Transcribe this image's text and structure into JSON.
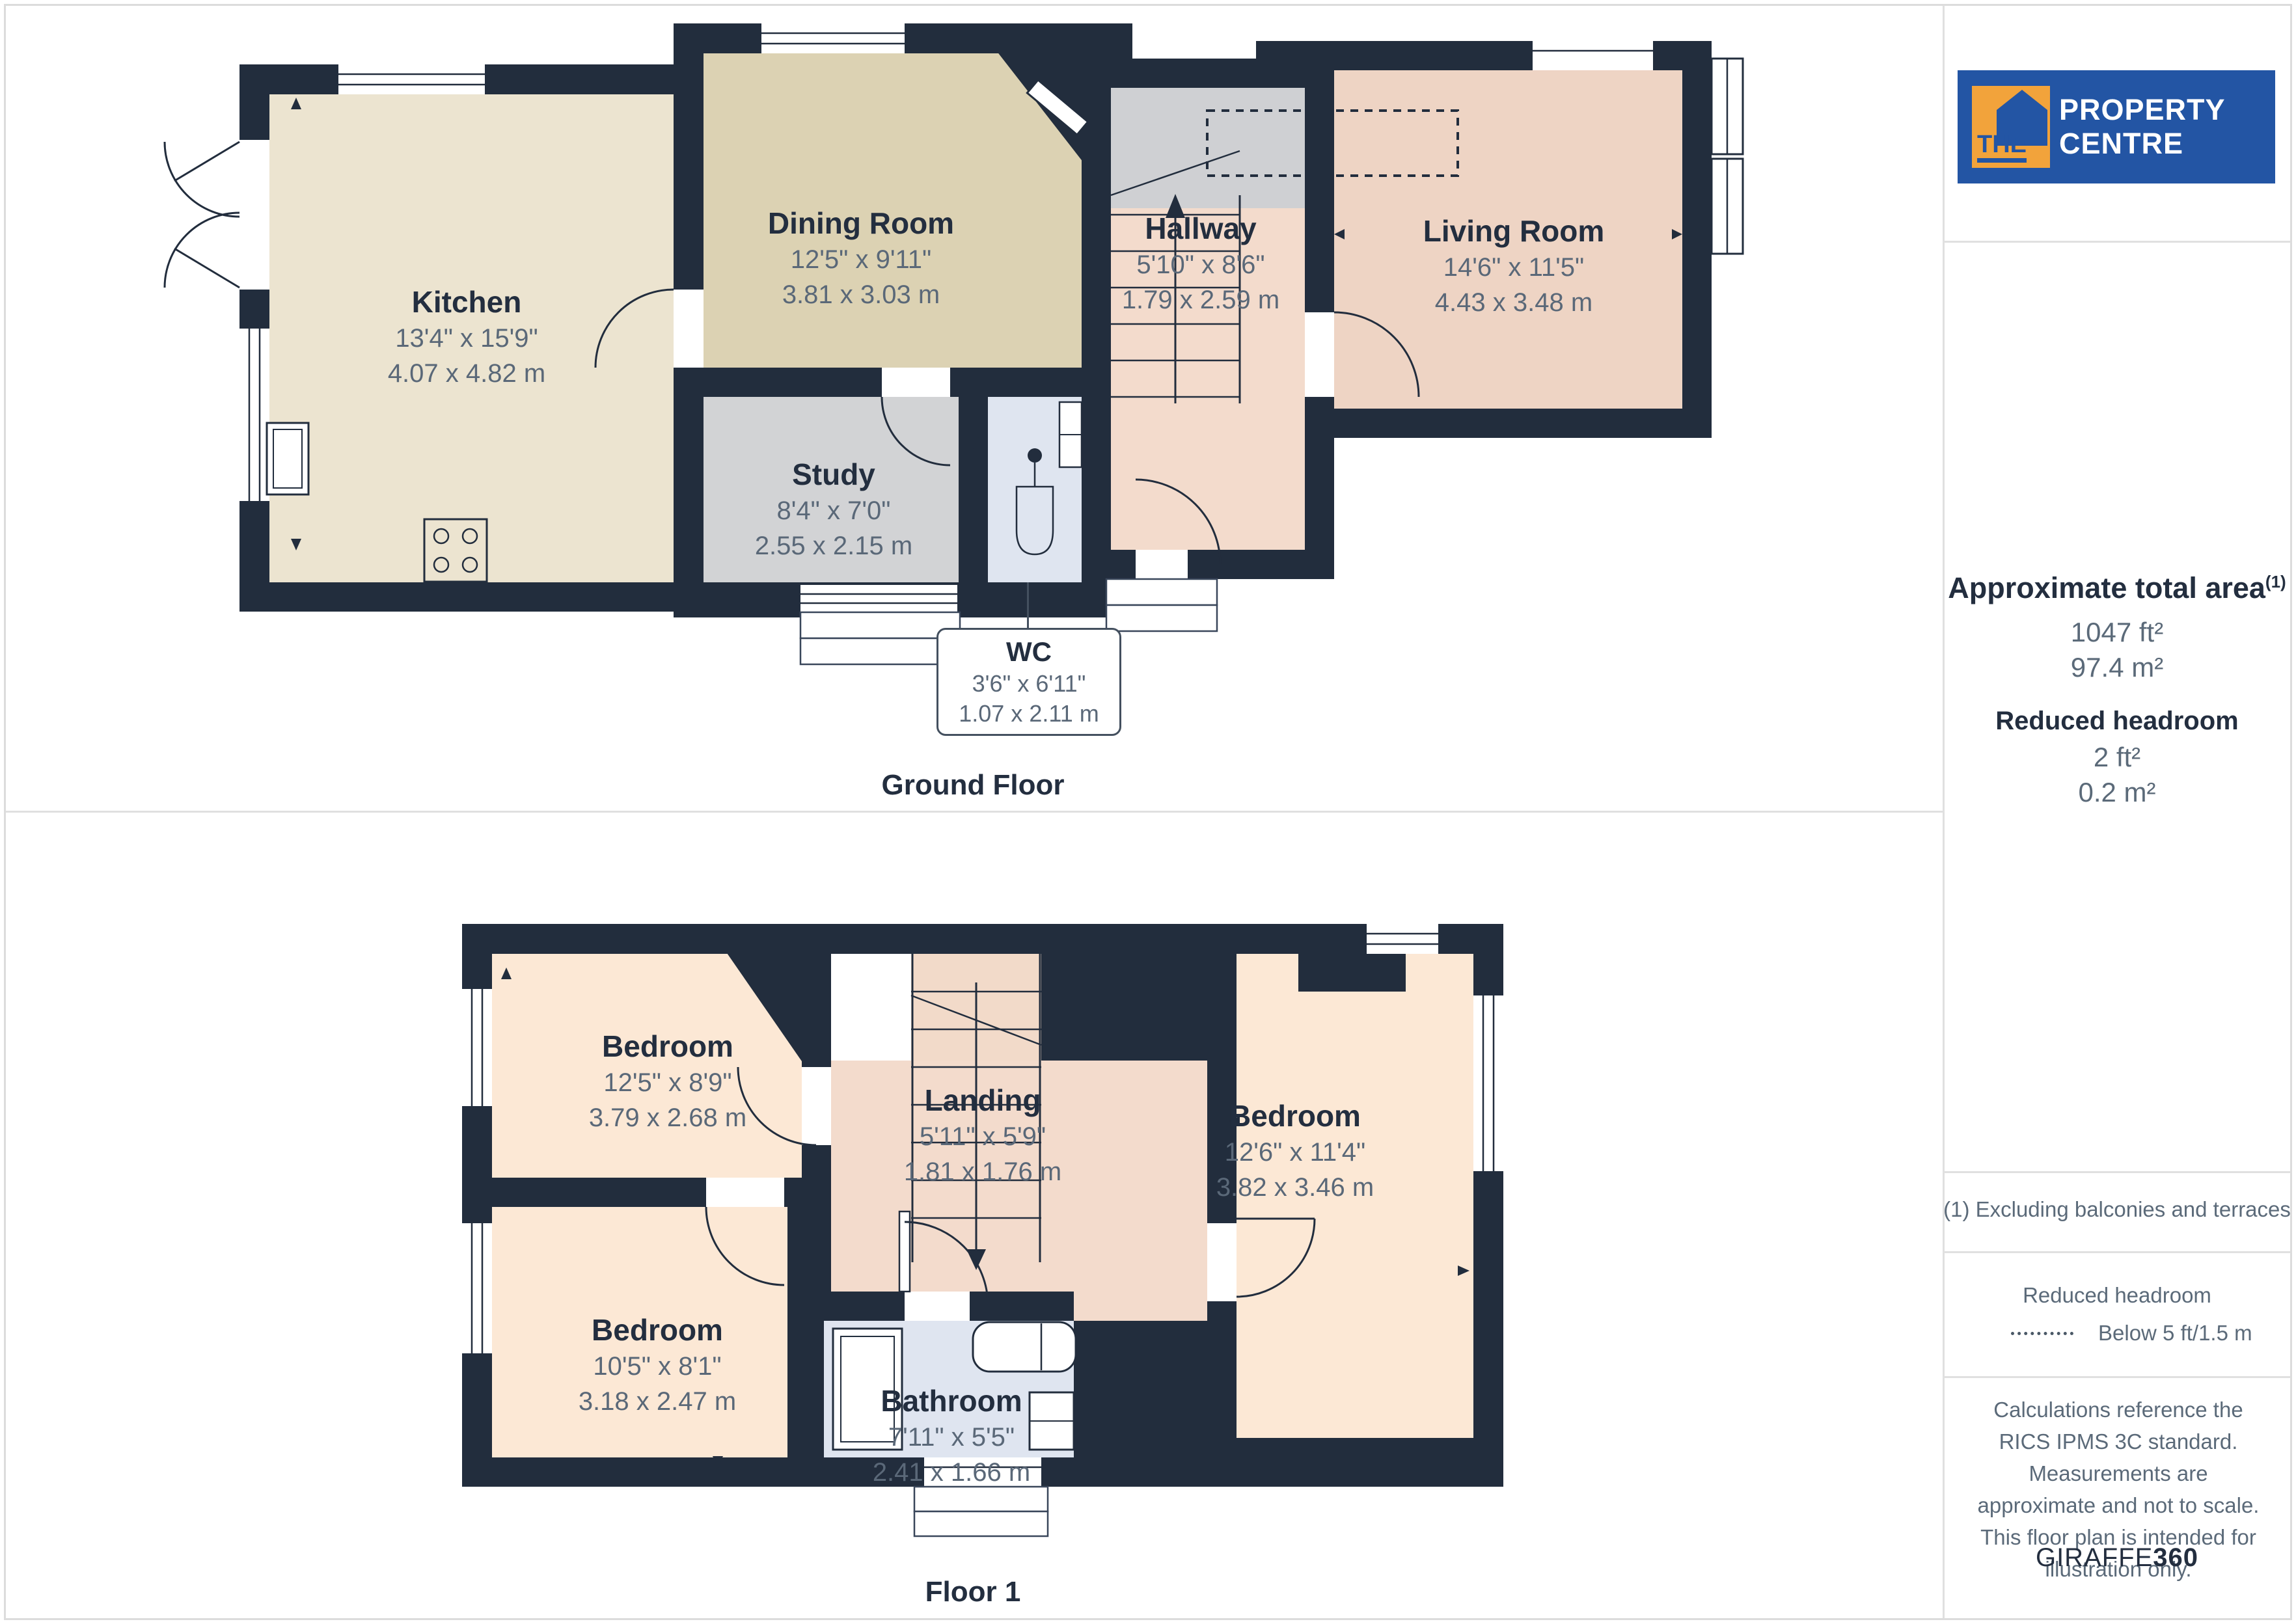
{
  "branding": {
    "the": "THE",
    "name": "PROPERTY CENTRE",
    "colors": {
      "brand_blue": "#2355a4",
      "brand_orange": "#f2a33b"
    }
  },
  "colors": {
    "wall": "#222d3d",
    "kitchen": "#ece4d0",
    "dining": "#dcd2b3",
    "study": "#d2d3d5",
    "wc_bath": "#dfe5f0",
    "hall_landing": "#f3dbcc",
    "living": "#eed4c4",
    "bedroom": "#fce8d5",
    "stair_gray": "#cfd0d3",
    "room_name_text": "#232e3f",
    "dimension_text": "#5a6878"
  },
  "ground": {
    "floor_label": "Ground Floor",
    "rooms": [
      {
        "name": "Kitchen",
        "imperial": "13'4\" x 15'9\"",
        "metric": "4.07 x 4.82 m"
      },
      {
        "name": "Dining Room",
        "imperial": "12'5\" x 9'11\"",
        "metric": "3.81 x 3.03 m"
      },
      {
        "name": "Hallway",
        "imperial": "5'10\" x 8'6\"",
        "metric": "1.79 x 2.59 m"
      },
      {
        "name": "Living Room",
        "imperial": "14'6\" x 11'5\"",
        "metric": "4.43 x 3.48 m"
      },
      {
        "name": "Study",
        "imperial": "8'4\" x 7'0\"",
        "metric": "2.55 x 2.15 m"
      },
      {
        "name": "WC",
        "imperial": "3'6\" x 6'11\"",
        "metric": "1.07 x 2.11 m"
      }
    ]
  },
  "floor1": {
    "floor_label": "Floor 1",
    "rooms": [
      {
        "name": "Bedroom",
        "imperial": "12'5\" x 8'9\"",
        "metric": "3.79 x 2.68 m"
      },
      {
        "name": "Landing",
        "imperial": "5'11\" x 5'9\"",
        "metric": "1.81 x 1.76 m"
      },
      {
        "name": "Bedroom",
        "imperial": "12'6\" x 11'4\"",
        "metric": "3.82 x 3.46 m"
      },
      {
        "name": "Bedroom",
        "imperial": "10'5\" x 8'1\"",
        "metric": "3.18 x 2.47 m"
      },
      {
        "name": "Bathroom",
        "imperial": "7'11\" x 5'5\"",
        "metric": "2.41 x 1.66 m"
      }
    ]
  },
  "sidebar": {
    "area_title": "Approximate total area",
    "area_sup": "(1)",
    "area_ft": "1047 ft²",
    "area_m": "97.4 m²",
    "reduced_title": "Reduced headroom",
    "reduced_ft": "2 ft²",
    "reduced_m": "0.2 m²",
    "footnote": "(1) Excluding balconies and terraces",
    "legend_title": "Reduced headroom",
    "legend_value": "Below 5 ft/1.5 m",
    "disclaimer": "Calculations reference the RICS IPMS 3C standard. Measurements are approximate and not to scale. This floor plan is intended for illustration only.",
    "brand_giraffe": "GIRAFFE",
    "brand_360": "360"
  }
}
